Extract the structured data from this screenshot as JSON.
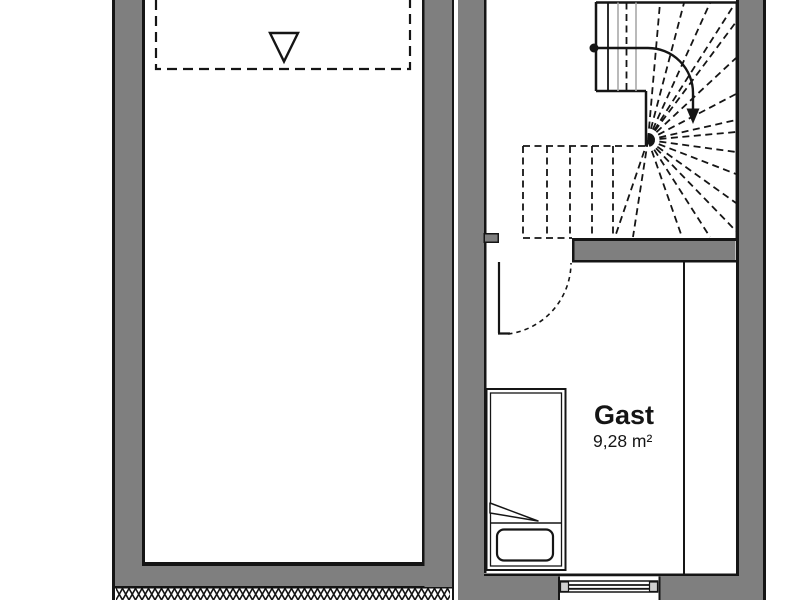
{
  "colors": {
    "background": "#ffffff",
    "wall_fill": "#7f7f7f",
    "line": "#151515",
    "stair_secondary_line": "#a9a9a9",
    "window_block_fill": "#cfcfcf"
  },
  "rooms": {
    "guest": {
      "name": "Gast",
      "area": "9,28 m²"
    }
  }
}
